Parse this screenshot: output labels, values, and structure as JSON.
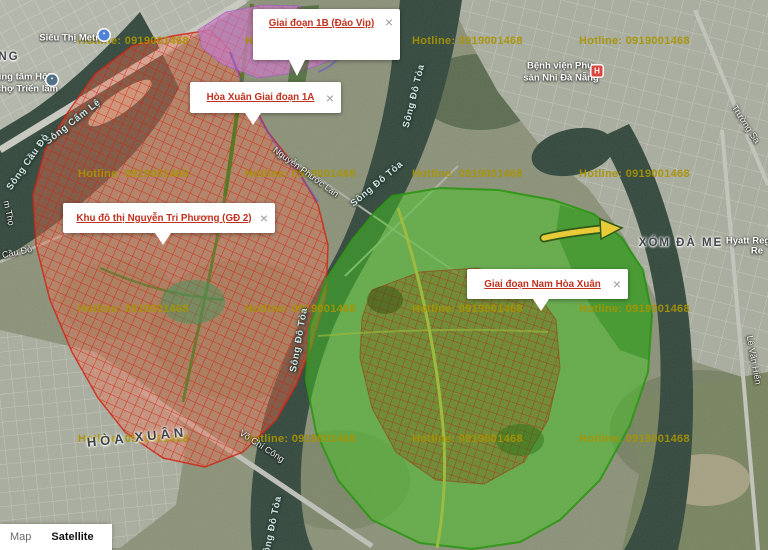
{
  "ui": {
    "map_label": "Map",
    "satellite_label": "Satellite",
    "close_glyph": "×"
  },
  "colors": {
    "overlay_red": "#d6200c",
    "overlay_purple": "#ba82e0",
    "overlay_green": "#3cc01e",
    "arrow_yellow": "#e9cb3a",
    "watermark": "#a89400",
    "info_link_red": "#c0311f",
    "water": "#32473c"
  },
  "watermark": {
    "text": "Hotline: 0919001468",
    "cols": [
      78,
      245,
      412,
      579
    ],
    "rows": [
      35,
      168,
      303,
      433
    ]
  },
  "info_windows": [
    {
      "name": "info-window-giai-doan-1b",
      "text": "Giai đoạn 1B (Đảo Vip)",
      "x": 253,
      "y": 9,
      "w": 147,
      "h": 51,
      "tail_pct": 30,
      "tail_h": 16,
      "align": "top"
    },
    {
      "name": "info-window-hoa-xuan-1a",
      "text": "Hòa Xuân Giai đoạn 1A",
      "x": 190,
      "y": 82,
      "w": 151,
      "h": 31,
      "tail_pct": 42,
      "tail_h": 12
    },
    {
      "name": "info-window-nguyen-tri-phuong",
      "text": "Khu đô thị Nguyễn Tri Phương (GĐ 2)",
      "x": 63,
      "y": 203,
      "w": 212,
      "h": 30,
      "tail_pct": 47,
      "tail_h": 12
    },
    {
      "name": "info-window-nam-hoa-xuan",
      "text": "Giai đoạn Nam Hòa Xuân",
      "x": 467,
      "y": 269,
      "w": 161,
      "h": 30,
      "tail_pct": 46,
      "tail_h": 12
    }
  ],
  "map_labels": [
    {
      "n": "sieu-thi-metro-label",
      "t": "Siêu Thị Metro",
      "x": 72,
      "y": 38,
      "r": 0,
      "c": "place"
    },
    {
      "n": "locality-ng-label",
      "t": "NG",
      "x": 9,
      "y": 57,
      "r": 0,
      "c": "locality"
    },
    {
      "n": "exhibition-center-label-1",
      "t": "ung tâm Hội",
      "x": 23,
      "y": 77,
      "r": 0,
      "c": "place"
    },
    {
      "n": "exhibition-center-label-2",
      "t": "chợ Triển lãm",
      "x": 27,
      "y": 89,
      "r": 0,
      "c": "place"
    },
    {
      "n": "song-cam-le-label",
      "t": "Sông Cẩm Lệ",
      "x": 73,
      "y": 122,
      "r": -38,
      "c": "water"
    },
    {
      "n": "song-cau-do-label",
      "t": "Sông Cầu Đỏ",
      "x": 28,
      "y": 162,
      "r": -55,
      "c": "water"
    },
    {
      "n": "road-fragment-label",
      "t": "m Thọ",
      "x": 9,
      "y": 213,
      "r": 78,
      "c": "road"
    },
    {
      "n": "cau-do-label",
      "t": "Cầu Đỏ",
      "x": 17,
      "y": 252,
      "r": -12,
      "c": "road"
    },
    {
      "n": "song-do-toa-label-1",
      "t": "Sông Đô Tỏa",
      "x": 414,
      "y": 96,
      "r": -76,
      "c": "water"
    },
    {
      "n": "song-do-toa-label-2",
      "t": "Sông Đô Tỏa",
      "x": 377,
      "y": 184,
      "r": -40,
      "c": "water"
    },
    {
      "n": "song-do-toa-label-3",
      "t": "Sông Đô Tỏa",
      "x": 299,
      "y": 340,
      "r": -80,
      "c": "water"
    },
    {
      "n": "song-do-toa-label-4",
      "t": "Sông Đô Tỏa",
      "x": 272,
      "y": 528,
      "r": -78,
      "c": "water"
    },
    {
      "n": "nguyen-phuoc-lan-label",
      "t": "Nguyễn Phước Lan",
      "x": 306,
      "y": 172,
      "r": 36,
      "c": "road"
    },
    {
      "n": "hoa-xuan-label",
      "t": "HÒA XUÂN",
      "x": 137,
      "y": 437,
      "r": -6,
      "c": "locality-lg"
    },
    {
      "n": "vo-chi-cong-label",
      "t": "Võ Chí Công",
      "x": 262,
      "y": 446,
      "r": 33,
      "c": "road"
    },
    {
      "n": "xom-da-me-label",
      "t": "XÓM ĐÀ ME",
      "x": 681,
      "y": 243,
      "r": 0,
      "c": "locality"
    },
    {
      "n": "hyatt-label-1",
      "t": "Hyatt Reg",
      "x": 748,
      "y": 241,
      "r": 0,
      "c": "place"
    },
    {
      "n": "hyatt-label-2",
      "t": "Re",
      "x": 757,
      "y": 251,
      "r": 0,
      "c": "place"
    },
    {
      "n": "hospital-label-1",
      "t": "Bệnh viện Phụ",
      "x": 560,
      "y": 66,
      "r": 0,
      "c": "place"
    },
    {
      "n": "hospital-label-2",
      "t": "sản Nhi Đà Nẵng",
      "x": 561,
      "y": 78,
      "r": 0,
      "c": "place"
    },
    {
      "n": "truong-sa-label",
      "t": "Trường Sa",
      "x": 746,
      "y": 124,
      "r": 57,
      "c": "road"
    },
    {
      "n": "le-van-hien-label",
      "t": "Lê Văn Hiến",
      "x": 754,
      "y": 360,
      "r": 80,
      "c": "road"
    }
  ],
  "map_icons": [
    {
      "type": "shopping-icon",
      "x": 104,
      "y": 35,
      "color": "#4d82d6",
      "glyph": "▪"
    },
    {
      "type": "exhibition-icon",
      "x": 52,
      "y": 80,
      "color": "#4f7086",
      "glyph": "▪"
    },
    {
      "type": "hospital-icon",
      "x": 597,
      "y": 71,
      "color": "#db453c",
      "glyph": "H"
    }
  ]
}
